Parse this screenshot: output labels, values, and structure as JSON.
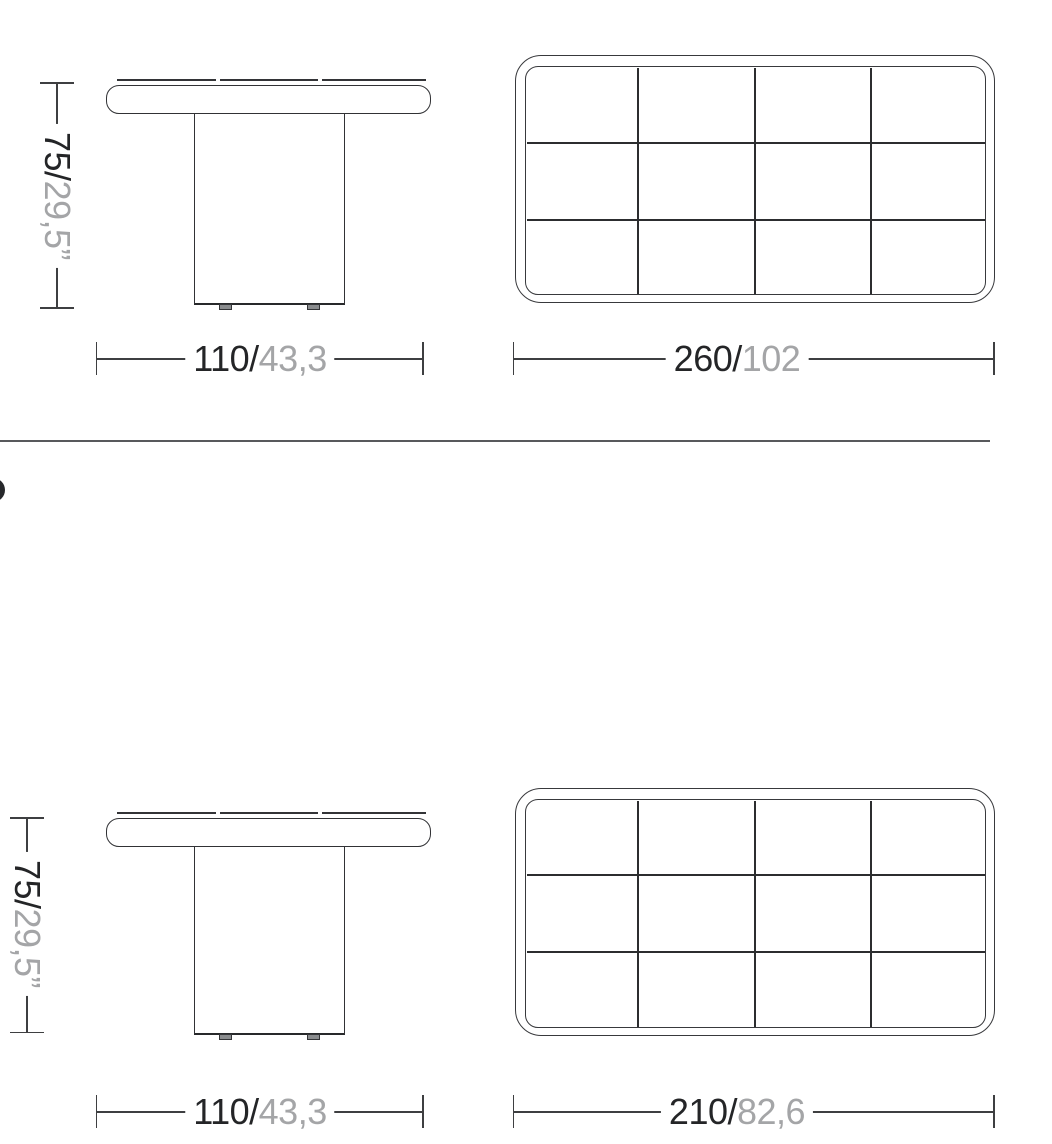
{
  "document": {
    "kind": "furniture dimension drawing",
    "views": [
      "side elevation",
      "top plan"
    ],
    "units": "cm/inches"
  },
  "colors": {
    "background": "#ffffff",
    "drawing_line": "#313235",
    "grid_line": "#2c2d2f",
    "dimension_line": "#3e3f41",
    "dimension_text_primary": "#242527",
    "dimension_text_secondary": "#a4a5a7",
    "divider": "#58595c",
    "logo_fragment": "#26282b"
  },
  "sections": {
    "top": {
      "side_view": {
        "height_dim": {
          "value_cm": "75/",
          "value_in": "29,5”"
        },
        "width_dim": {
          "value_cm": "110/",
          "value_in": "43,3"
        }
      },
      "top_view": {
        "width_dim": {
          "value_cm": "260/",
          "value_in": "102"
        },
        "grid_columns": 4,
        "grid_rows": 3
      }
    },
    "bottom": {
      "side_view": {
        "height_dim": {
          "value_cm": "75/",
          "value_in": "29,5”"
        },
        "width_dim": {
          "value_cm": "110/",
          "value_in": "43,3"
        }
      },
      "top_view": {
        "width_dim": {
          "value_cm": "210/",
          "value_in": "82,6"
        },
        "grid_columns": 4,
        "grid_rows": 3
      }
    }
  }
}
